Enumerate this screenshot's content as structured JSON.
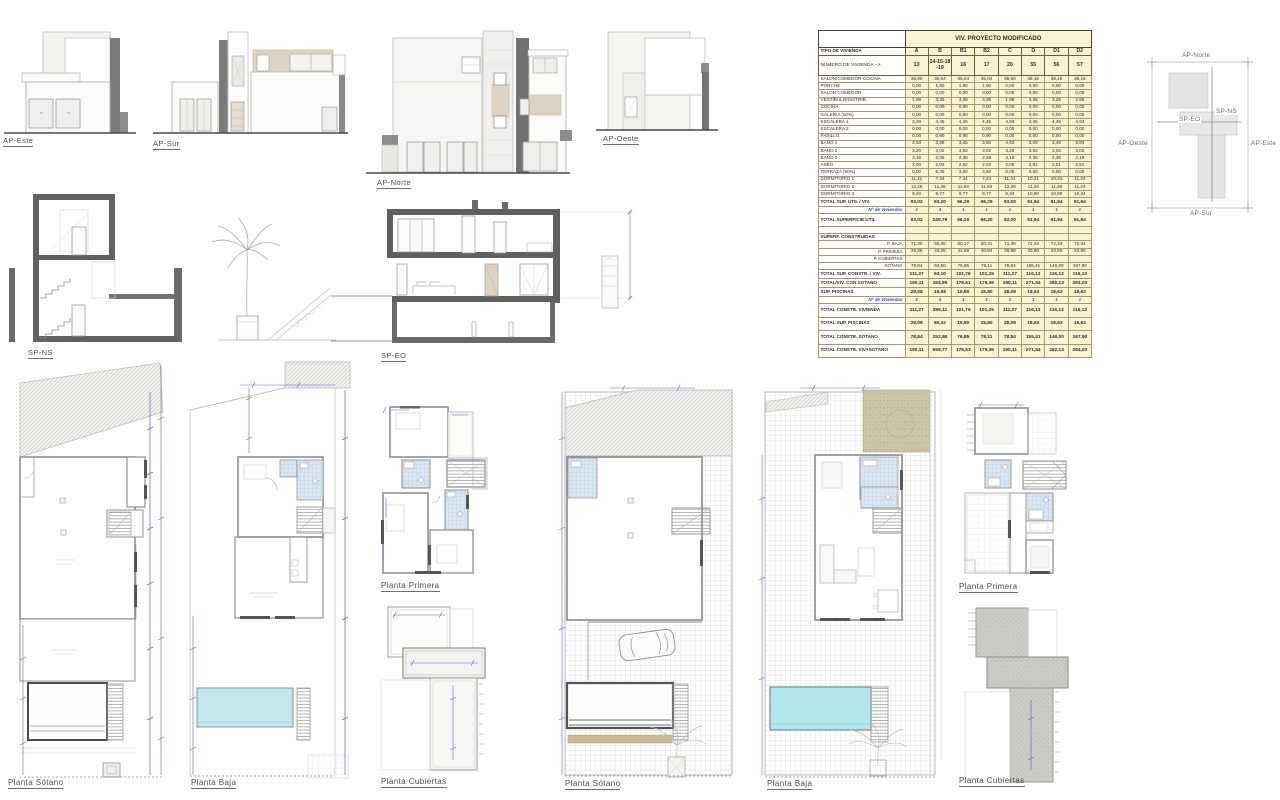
{
  "colors": {
    "table_fill": "#fbf2cf",
    "table_border": "#6b5c3e",
    "dim_blue": "#5b68c8",
    "pool_cyan": "#b5e6ee",
    "accent_dark": "#6e6e6c",
    "beige_panel": "#ddd2c3",
    "blue_text": "#2b50bb"
  },
  "elevations": [
    {
      "label": "AP-Este"
    },
    {
      "label": "AP-Sur"
    },
    {
      "label": "AP-Norte"
    },
    {
      "label": "AP-Oeste"
    }
  ],
  "sections": [
    {
      "label": "SP-NS"
    },
    {
      "label": "SP-EO"
    }
  ],
  "plans": [
    {
      "label": "Planta Sótano"
    },
    {
      "label": "Planta Baja"
    },
    {
      "label": "Planta Primera"
    },
    {
      "label": "Planta Cubiertas"
    },
    {
      "label": "Planta Sótano"
    },
    {
      "label": "Planta Baja"
    },
    {
      "label": "Planta Primera"
    },
    {
      "label": "Planta Cubiertas"
    }
  ],
  "site_key": {
    "north": "AP-Norte",
    "west": "AP-Oeste",
    "east": "AP-Este",
    "south": "AP-Sur",
    "section_ns": "SP-NS",
    "section_eo": "SP-EO"
  },
  "table": {
    "title": "VIV. PROYECTO MODIFICADO",
    "corner_label": "TIPO DE VIVIENDA",
    "number_label": "NUMERO DE VIVIENDA -->",
    "types": [
      "A",
      "B",
      "B1",
      "B2",
      "C",
      "D",
      "D1",
      "D2"
    ],
    "numbers": [
      "13",
      "14-15-18-19",
      "16",
      "17",
      "20",
      "55",
      "56",
      "57"
    ],
    "rows": [
      {
        "label": "SALON/COMEDOR-COCINA",
        "cells": [
          "38,90",
          "35,04",
          "35,04",
          "35,04",
          "38,90",
          "38,15",
          "38,15",
          "38,15"
        ]
      },
      {
        "label": "PORCHE",
        "cells": [
          "0,00",
          "1,90",
          "1,90",
          "1,90",
          "0,00",
          "0,00",
          "0,00",
          "0,00"
        ]
      },
      {
        "label": "SALON COMEDOR",
        "cells": [
          "0,00",
          "0,00",
          "0,00",
          "0,00",
          "0,00",
          "0,00",
          "0,00",
          "0,00"
        ]
      },
      {
        "label": "VESTIBULO/DISTRIB.",
        "cells": [
          "1,99",
          "3,35",
          "3,35",
          "3,35",
          "1,99",
          "3,26",
          "3,26",
          "2,95"
        ]
      },
      {
        "label": "COCINA",
        "cells": [
          "0,00",
          "0,00",
          "0,00",
          "0,00",
          "0,00",
          "0,00",
          "0,00",
          "0,00"
        ]
      },
      {
        "label": "GALERIA (50%)",
        "cells": [
          "0,00",
          "0,00",
          "0,00",
          "0,00",
          "0,00",
          "0,00",
          "0,00",
          "0,00"
        ]
      },
      {
        "label": "ESCALERA 1",
        "cells": [
          "3,29",
          "4,45",
          "4,45",
          "4,45",
          "4,93",
          "4,45",
          "4,45",
          "4,93"
        ]
      },
      {
        "label": "ESCALERA 2",
        "cells": [
          "0,00",
          "0,00",
          "0,00",
          "0,00",
          "0,00",
          "0,00",
          "0,00",
          "0,00"
        ]
      },
      {
        "label": "PASILLO",
        "cells": [
          "0,00",
          "0,90",
          "0,90",
          "0,90",
          "0,00",
          "0,00",
          "0,00",
          "0,00"
        ]
      },
      {
        "label": "BAÑO 1",
        "cells": [
          "4,53",
          "3,98",
          "3,45",
          "3,50",
          "4,53",
          "3,09",
          "3,49",
          "3,93"
        ]
      },
      {
        "label": "BAÑO 2",
        "cells": [
          "3,20",
          "3,02",
          "3,02",
          "3,02",
          "3,20",
          "3,02",
          "3,02",
          "3,02"
        ]
      },
      {
        "label": "BAÑO 3",
        "cells": [
          "3,18",
          "2,39",
          "2,39",
          "2,39",
          "3,18",
          "2,36",
          "2,36",
          "2,19"
        ]
      },
      {
        "label": "ASEO",
        "cells": [
          "2,00",
          "2,02",
          "2,02",
          "2,02",
          "2,00",
          "2,51",
          "2,51",
          "2,51"
        ]
      },
      {
        "label": "TERRAZA (50%)",
        "cells": [
          "0,00",
          "6,35",
          "3,60",
          "3,60",
          "0,00",
          "0,00",
          "0,00",
          "0,00"
        ]
      },
      {
        "label": "DORMITORIO 1",
        "cells": [
          "11,41",
          "7,44",
          "7,44",
          "7,44",
          "11,41",
          "10,31",
          "10,31",
          "11,24"
        ]
      },
      {
        "label": "DORMITORIO 2",
        "cells": [
          "12,28",
          "11,38",
          "11,83",
          "11,83",
          "12,28",
          "11,34",
          "11,39",
          "11,24"
        ]
      },
      {
        "label": "DORMITORIO 3",
        "cells": [
          "9,34",
          "9,77",
          "9,77",
          "9,77",
          "9,34",
          "10,90",
          "10,90",
          "10,24"
        ]
      },
      {
        "label": "TOTAL SUP. UTIL / VIV.",
        "style": "bold",
        "cells": [
          "93,02",
          "93,20",
          "66,29",
          "66,29",
          "93,00",
          "91,94",
          "91,94",
          "91,94"
        ]
      },
      {
        "label": "Nº de Viviendas",
        "style": "blue",
        "cells": [
          "1",
          "4",
          "1",
          "1",
          "1",
          "1",
          "1",
          "1"
        ]
      },
      {
        "label": "TOTAL SUPERFICIE UTIL",
        "style": "tall",
        "cells": [
          "93,02",
          "240,79",
          "66,20",
          "66,20",
          "93,00",
          "91,94",
          "91,94",
          "91,94"
        ]
      },
      {
        "label": "",
        "style": "blank",
        "cells": [
          "",
          "",
          "",
          "",
          "",
          "",
          "",
          ""
        ]
      },
      {
        "label": "SUPERF. CONSTRUIDAS",
        "style": "section",
        "cells": [
          "",
          "",
          "",
          "",
          "",
          "",
          "",
          ""
        ]
      },
      {
        "label": "P. BAJA",
        "style": "sub",
        "cells": [
          "71,39",
          "55,08",
          "60,17",
          "60,41",
          "71,39",
          "72,34",
          "72,34",
          "72,34"
        ]
      },
      {
        "label": "P. PRIMERA",
        "style": "sub",
        "cells": [
          "39,88",
          "43,25",
          "41,59",
          "40,84",
          "39,88",
          "43,80",
          "43,80",
          "43,80"
        ]
      },
      {
        "label": "P. CUBIERTAS",
        "style": "sub",
        "cells": [
          "",
          "",
          "",
          "",
          "",
          "",
          "",
          ""
        ]
      },
      {
        "label": "SOTANO",
        "style": "sub",
        "cells": [
          "78,84",
          "63,50",
          "76,85",
          "78,11",
          "78,84",
          "155,41",
          "146,00",
          "167,90"
        ]
      },
      {
        "label": "TOTAL SUP. CONSTR. / VIV.",
        "style": "bold",
        "cells": [
          "111,27",
          "93,10",
          "101,76",
          "101,25",
          "111,27",
          "116,13",
          "116,13",
          "116,13"
        ]
      },
      {
        "label": "TOTAL/VIV. CON SOTANO",
        "style": "bold",
        "cells": [
          "190,11",
          "164,99",
          "178,61",
          "179,36",
          "190,11",
          "271,54",
          "262,13",
          "284,03"
        ]
      },
      {
        "label": "SUP. PISCINAS",
        "style": "bold",
        "cells": [
          "28,08",
          "15,08",
          "15,80",
          "15,80",
          "28,08",
          "18,63",
          "18,63",
          "18,63"
        ]
      },
      {
        "label": "Nº de Viviendas",
        "style": "blue",
        "cells": [
          "1",
          "4",
          "1",
          "1",
          "1",
          "1",
          "1",
          "1"
        ]
      },
      {
        "label": "TOTAL CONSTR. VIVIENDA",
        "style": "tall",
        "cells": [
          "111,27",
          "396,11",
          "101,76",
          "101,25",
          "111,27",
          "116,13",
          "116,13",
          "116,13"
        ]
      },
      {
        "label": "TOTAL SUP. PISCINAS",
        "style": "tall",
        "cells": [
          "28,08",
          "60,32",
          "15,80",
          "15,80",
          "28,08",
          "18,63",
          "18,63",
          "18,63"
        ]
      },
      {
        "label": "TOTAL CONSTR. SOTANO",
        "style": "tall",
        "cells": [
          "78,84",
          "252,98",
          "76,85",
          "78,11",
          "78,84",
          "155,41",
          "146,00",
          "167,90"
        ]
      },
      {
        "label": "TOTAL CONSTR. VIV+SOTANO",
        "style": "tall",
        "cells": [
          "190,11",
          "655,77",
          "178,63",
          "179,36",
          "190,11",
          "271,54",
          "262,13",
          "284,03"
        ]
      }
    ]
  }
}
